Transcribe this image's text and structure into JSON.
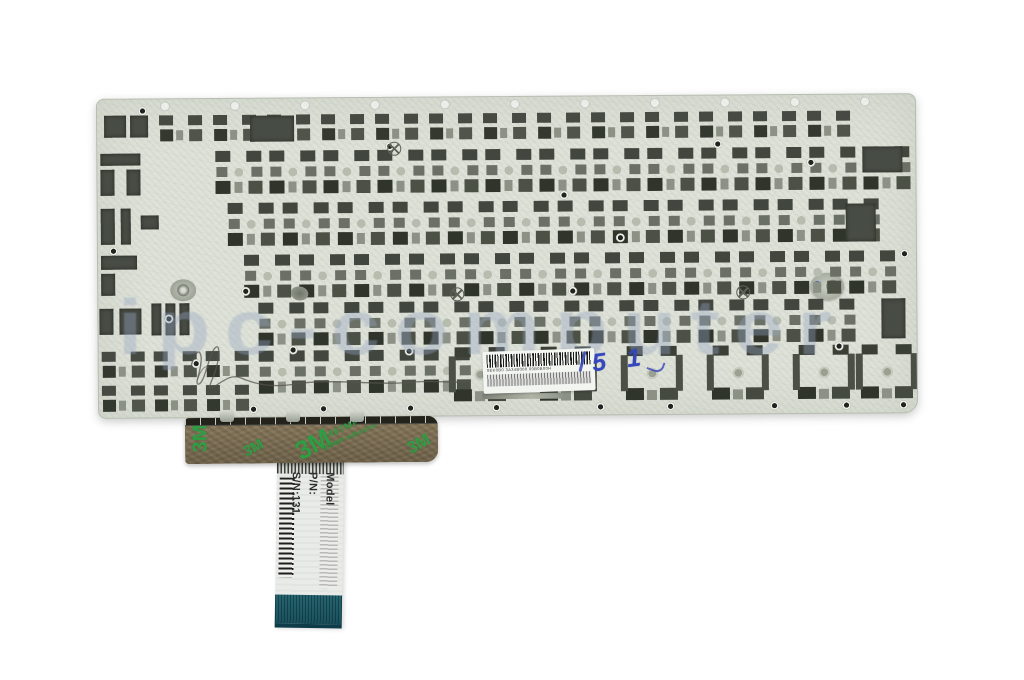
{
  "photo": {
    "watermark": "ipc-computer",
    "handwriting_blue": "5 1",
    "barcode_label": {
      "line1": "0EK0B0 3A34B000 00B0B00H"
    },
    "sticker": {
      "logos": [
        "3M",
        "3M",
        "3M",
        "3M"
      ],
      "code": "467MP",
      "subcode": "200MP Adhesive"
    },
    "cable_label": {
      "model": "Model",
      "pn": "P/N:",
      "sn": "S/N:131"
    }
  }
}
